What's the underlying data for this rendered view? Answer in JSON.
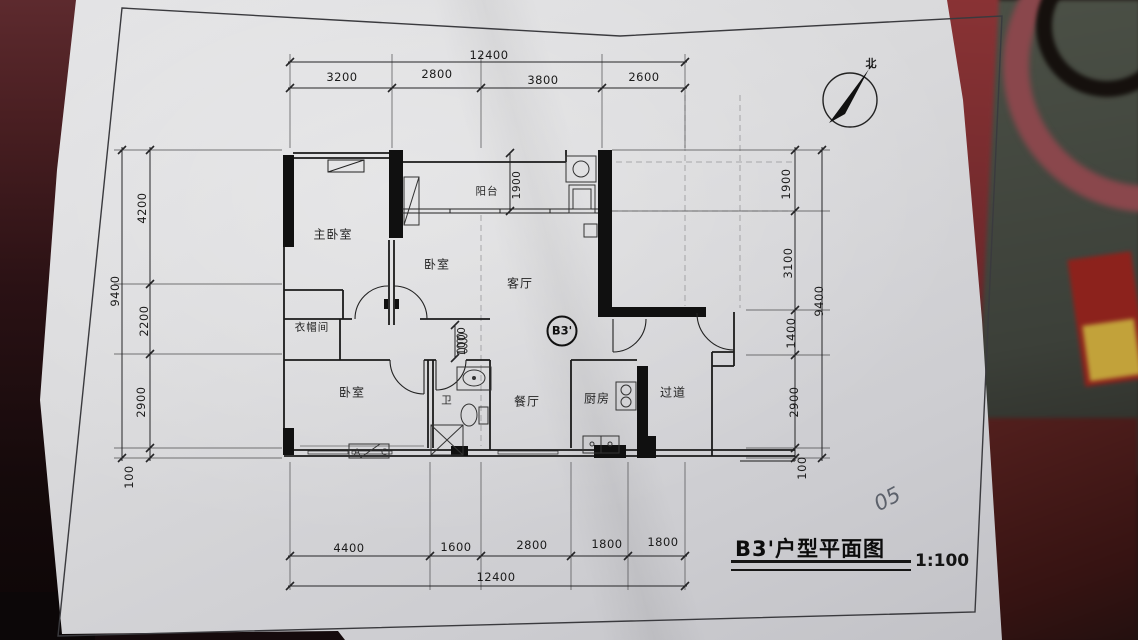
{
  "photo": {
    "palette": {
      "table_dark_red": "#4a1d1c",
      "table_deep_shadow": "#150a0c",
      "paper_gray": "#d9d9db",
      "decor_red_ring": "#8a474c",
      "decor_panel_gray": "#4b5046",
      "decor_accent_red": "#8c221c",
      "decor_accent_yellow": "#c2a23a",
      "ink": "#1b1b1b"
    }
  },
  "sheet": {
    "title": "B3'户型平面图",
    "scale_label": "1:100",
    "handwritten_note": "05",
    "north_label": "北",
    "unit_badge": "B3'",
    "ac_symbol": {
      "a": "A",
      "c": "C"
    },
    "rooms": {
      "master_bedroom": "主卧室",
      "bedroom2": "卧室",
      "balcony": "阳台",
      "living_room": "客厅",
      "cloakroom": "衣帽间",
      "bedroom3": "卧室",
      "bathroom": "卫",
      "dining_room": "餐厅",
      "kitchen": "厨房",
      "corridor": "过道"
    },
    "dims": {
      "top_overall": "12400",
      "top_segments": [
        "3200",
        "2800",
        "3800",
        "2600"
      ],
      "bottom_segments": [
        "4400",
        "1600",
        "2800",
        "1800",
        "1800"
      ],
      "bottom_overall": "12400",
      "left_overall": "9400",
      "left_segments": [
        "4200",
        "2200",
        "2900",
        "100"
      ],
      "right_overall": "9400",
      "right_segments": [
        "1900",
        "3100",
        "1400",
        "2900",
        "100"
      ],
      "internal": [
        "1900",
        "1000"
      ]
    }
  }
}
